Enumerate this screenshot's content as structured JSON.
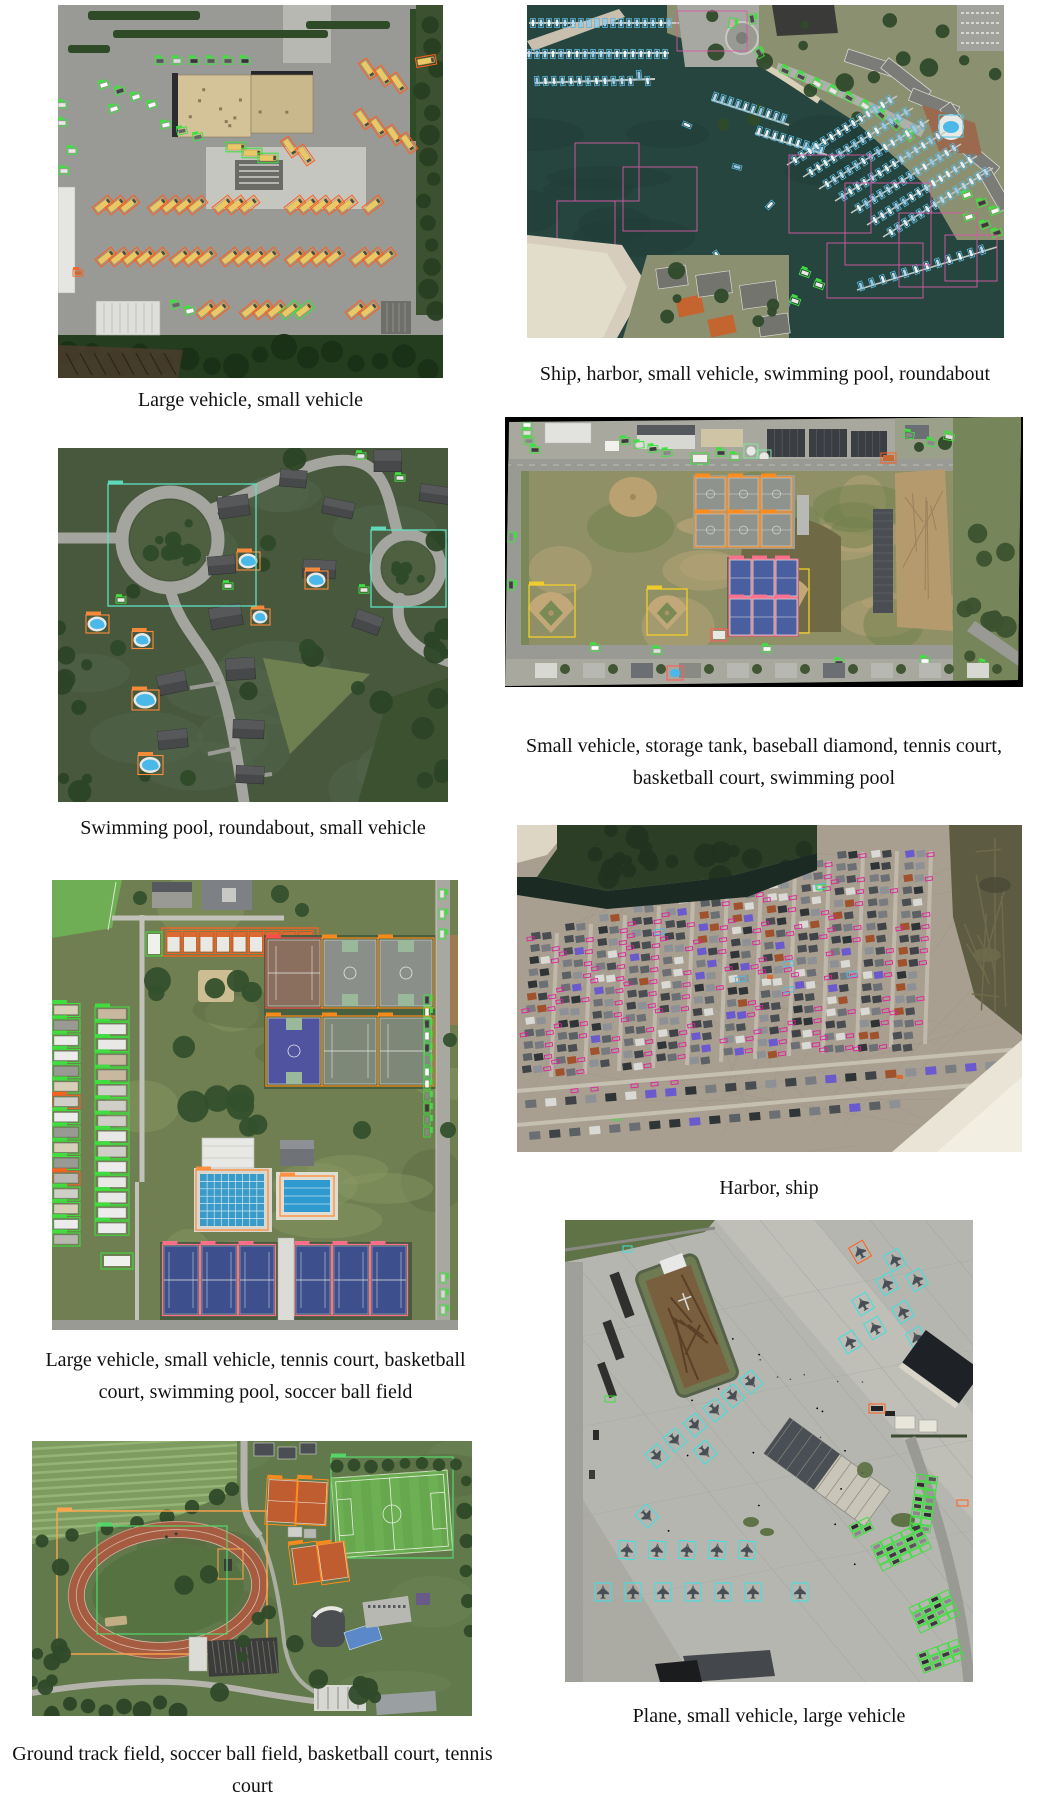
{
  "page_background": "#ffffff",
  "panels": [
    {
      "id": "bus-depot",
      "caption": "Large vehicle, small vehicle"
    },
    {
      "id": "marina",
      "caption": "Ship, harbor, small vehicle, swimming pool, roundabout"
    },
    {
      "id": "residential",
      "caption": "Swimming pool, roundabout, small vehicle"
    },
    {
      "id": "school-fields",
      "caption": "Small vehicle, storage tank, baseball diamond, tennis court, basketball court, swimming pool"
    },
    {
      "id": "sports-complex",
      "caption": "Large vehicle, small vehicle, tennis court, basketball court, swimming pool, soccer ball field"
    },
    {
      "id": "beach-harbor",
      "caption": "Harbor, ship"
    },
    {
      "id": "track-field",
      "caption": "Ground track field, soccer ball field, basketball court, tennis court"
    },
    {
      "id": "airport",
      "caption": "Plane, small vehicle, large vehicle"
    }
  ],
  "box_colors": {
    "large_vehicle": "#ff5f1f",
    "small_vehicle": "#3fe03f",
    "ship": "#55b8e0",
    "ship_alt": "#e020a0",
    "harbor": "#d858a8",
    "swimming_pool": "#ff8c3a",
    "swimming_pool_alt": "#49c8e8",
    "roundabout": "#5fe0c0",
    "storage_tank": "#7ee8a0",
    "baseball_diamond": "#f2cf2a",
    "tennis_court": "#ff7090",
    "tennis_court_alt": "#ff8c1a",
    "basketball_court": "#ff8c1a",
    "soccer_ball_field": "#54d96c",
    "ground_track_field": "#ffa64d",
    "plane": "#3fe0e0"
  }
}
